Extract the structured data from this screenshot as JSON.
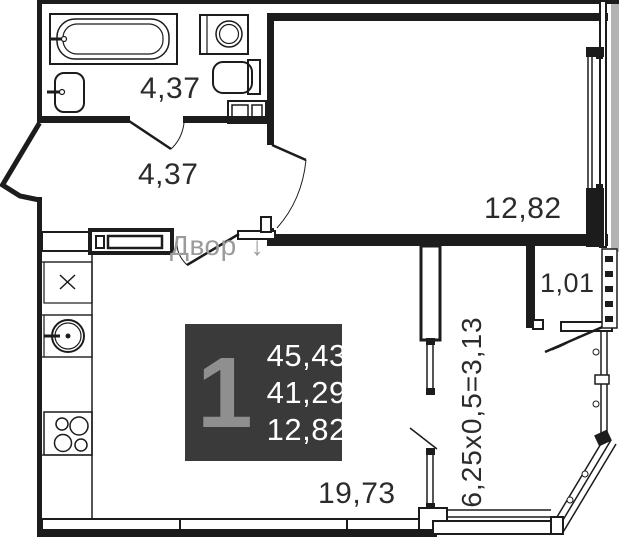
{
  "page": {
    "background": "#ffffff",
    "wall_color": "#1c1c1c",
    "edge_strip_color": "#b3b3b3"
  },
  "unit_card": {
    "unit_number": "1",
    "total_area": "45,43",
    "living_area": "41,29",
    "kitchen_area": "12,82",
    "bg_color": "#3a3a3a",
    "unit_number_color": "#8f8f8f",
    "text_color": "#ffffff"
  },
  "rooms": {
    "bathroom": {
      "area": "4,37"
    },
    "hallway": {
      "area": "4,37"
    },
    "bedroom": {
      "area": "12,82"
    },
    "niche": {
      "area": "1,01"
    },
    "kitchen_living": {
      "area": "19,73"
    },
    "balcony": {
      "dimension": "6,25x0,5=3,13"
    }
  },
  "annotations": {
    "courtyard_label": "Двор",
    "courtyard_arrow": "↓",
    "courtyard_color": "#9b9b9b"
  },
  "fixtures": [
    "bathtub",
    "bathroom-sink",
    "washing-machine",
    "toilet",
    "vanity-cabinet",
    "wardrobe",
    "kitchen-cabinet",
    "kitchen-sink",
    "stove",
    "balcony-glazing"
  ]
}
